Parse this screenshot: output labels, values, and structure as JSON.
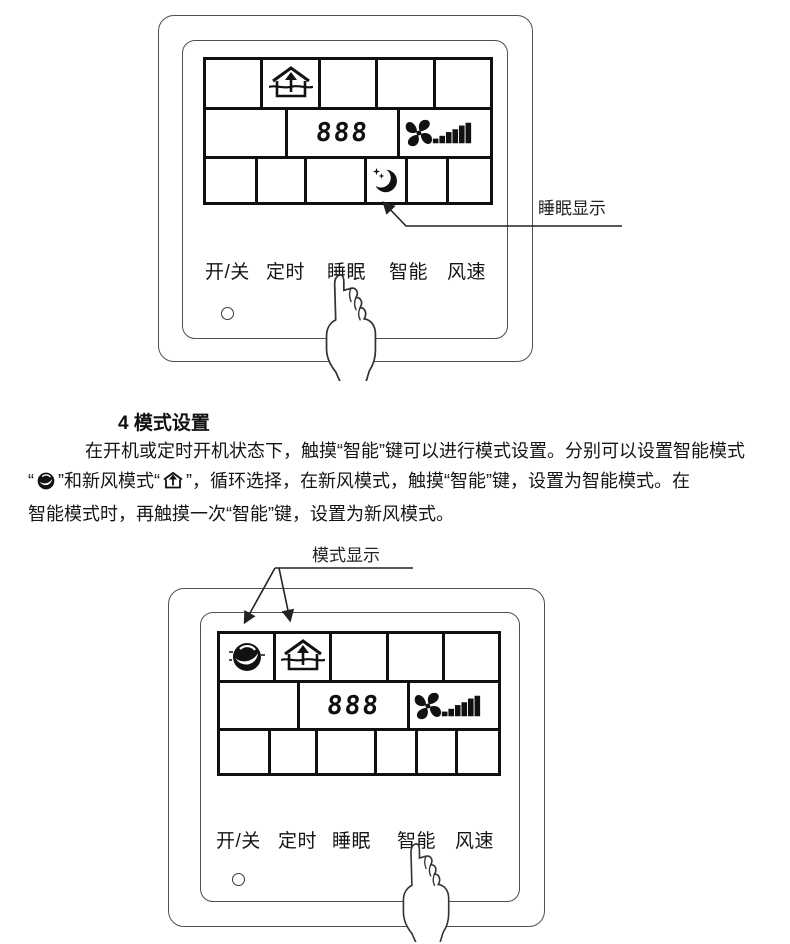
{
  "page": {
    "heading": "4 模式设置",
    "paragraph": {
      "line1": "在开机或定时开机状态下，触摸“智能”键可以进行模式设置。分别可以设置智能模式",
      "line2_open_quote": "“",
      "line2_between": "”和新风模式“",
      "line2_rest": "”，循环选择，在新风模式，触摸“智能”键，设置为智能模式。在",
      "line3": "智能模式时，再触摸一次“智能”键，设置为新风模式。"
    }
  },
  "top_panel": {
    "callout_label": "睡眠显示",
    "display_value": "888",
    "buttons": [
      "开/关",
      "定时",
      "睡眠",
      "智能",
      "风速"
    ]
  },
  "bottom_panel": {
    "callout_label": "模式显示",
    "display_value": "888",
    "buttons": [
      "开/关",
      "定时",
      "睡眠",
      "智能",
      "风速"
    ]
  },
  "icons": {
    "fresh_air_mode": "house-with-up-arrow",
    "smart_mode": "dark-swirl-circle",
    "fan_speed": "pinwheel-fan-with-level-bars",
    "sleep": "crescent-moon-with-stars",
    "pointing_hand": "finger-pointing-up"
  },
  "colors": {
    "ink": "#1a1a1a",
    "lcd_line": "#101010",
    "panel_line": "#4f4f4f"
  }
}
